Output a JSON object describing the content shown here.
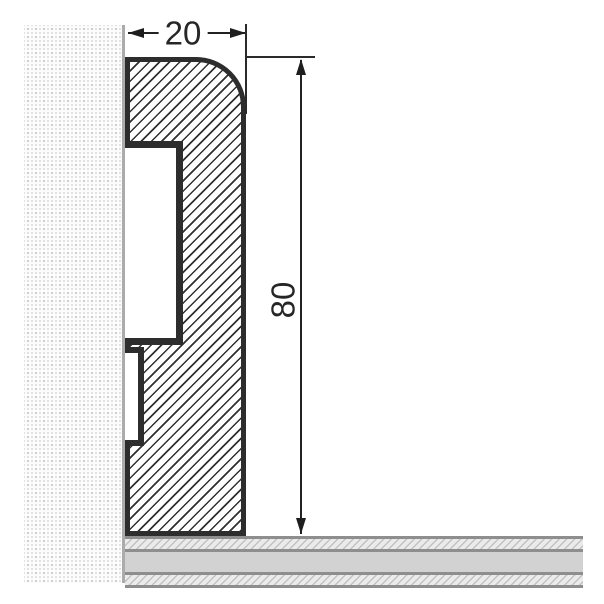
{
  "drawing": {
    "type": "technical-cross-section",
    "subject": "skirting-board profile mounted between wall and floor",
    "dimensions": {
      "width_mm": "20",
      "height_mm": "80"
    },
    "colors": {
      "outline": "#2d2d2d",
      "hatch_line": "#303030",
      "wall_dot": "#c4c4c4",
      "wall_edge": "#ababab",
      "floor_core": "#d2d2d2",
      "floor_border": "#8e8e8e",
      "dimension_line": "#222222",
      "background": "#ffffff"
    }
  }
}
